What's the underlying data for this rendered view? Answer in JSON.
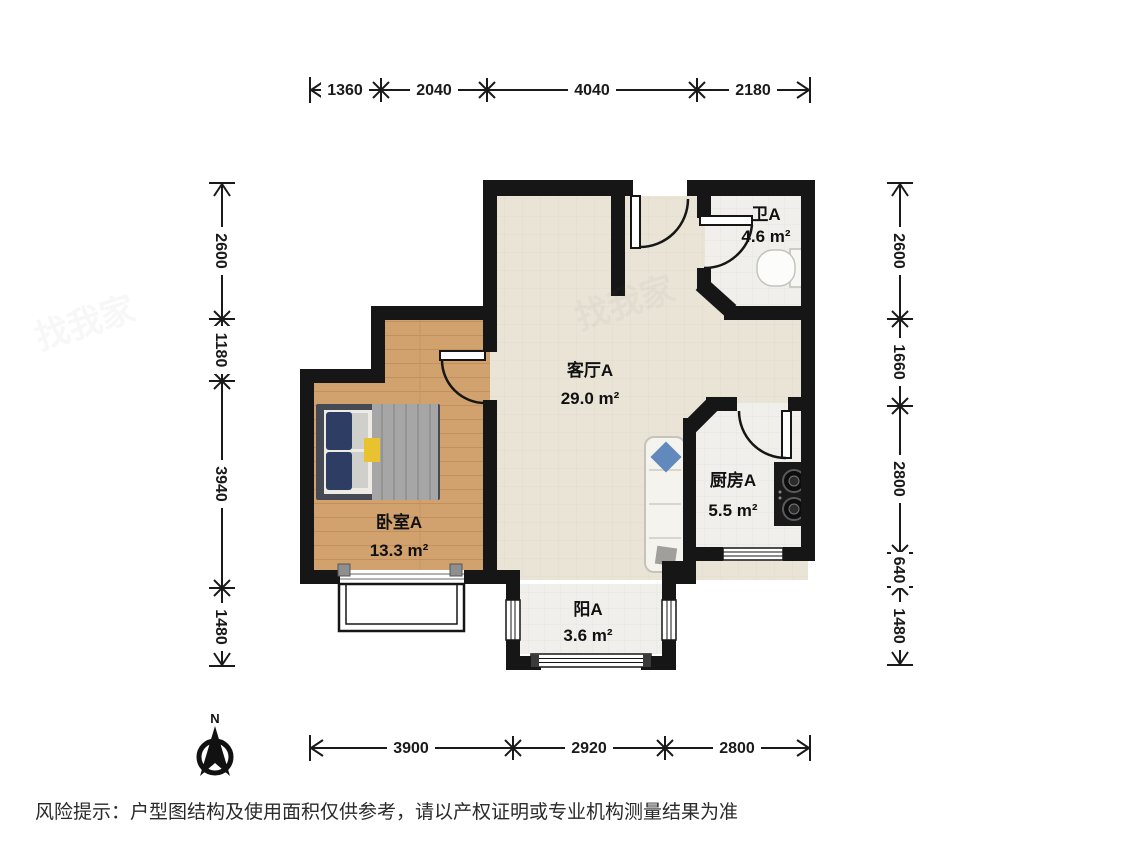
{
  "rooms": {
    "bathroom": {
      "label": "卫A",
      "area": "4.6 m²"
    },
    "living": {
      "label": "客厅A",
      "area": "29.0 m²"
    },
    "kitchen": {
      "label": "厨房A",
      "area": "5.5 m²"
    },
    "bedroom": {
      "label": "卧室A",
      "area": "13.3 m²"
    },
    "balcony": {
      "label": "阳A",
      "area": "3.6 m²"
    }
  },
  "dimensions": {
    "top": [
      "1360",
      "2040",
      "4040",
      "2180"
    ],
    "bottom": [
      "3900",
      "2920",
      "2800"
    ],
    "left": [
      "2600",
      "1180",
      "3940",
      "1480"
    ],
    "right": [
      "2600",
      "1660",
      "2800",
      "640",
      "1480"
    ]
  },
  "compass": {
    "label": "N"
  },
  "watermark": "找我家",
  "disclaimer": "风险提示：户型图结构及使用面积仅供参考，请以产权证明或专业机构测量结果为准",
  "colors": {
    "wall": "#161616",
    "living_floor": "#eae4d7",
    "wood_floor": "#d2a26e",
    "tile_floor": "#f0efec",
    "text": "#111111"
  }
}
